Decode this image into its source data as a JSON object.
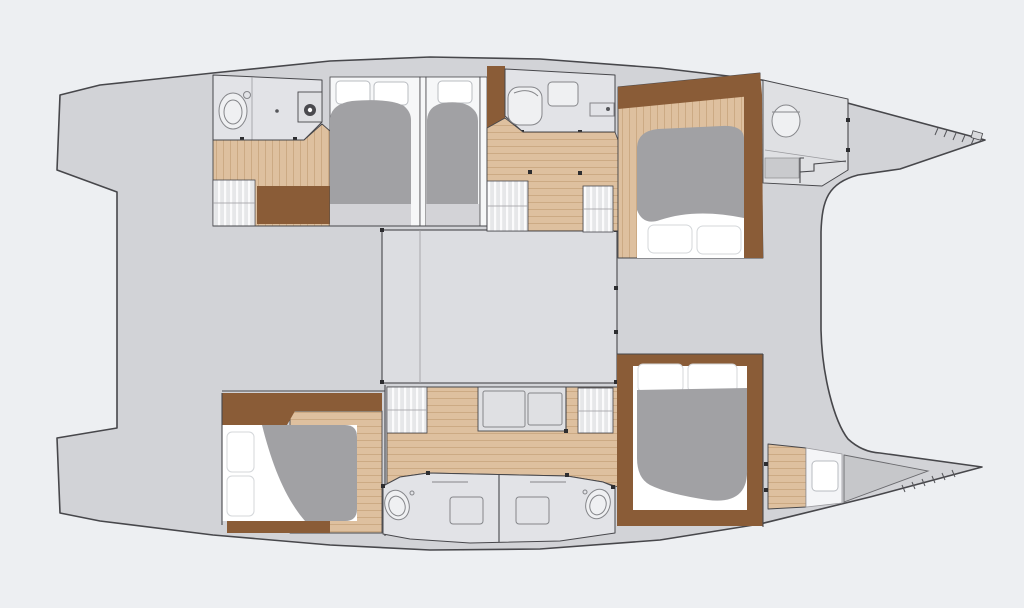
{
  "diagram": {
    "kind": "floor-plan",
    "subject": "catamaran-yacht-deck-layout",
    "orientation": "bow-right",
    "aria_label": "Catamaran yacht floor plan with bow facing right",
    "visible_text_items": []
  },
  "palette": {
    "bg": "#edeff2",
    "deck": "#d2d3d7",
    "saloon": "#dcdde1",
    "cabinWhite": "#f6f7f8",
    "mattress": "#ffffff",
    "wood": "#dec09f",
    "woodLine": "#c8a47d",
    "woodDark": "#8a5c37",
    "bedGray": "#a1a1a4",
    "benchGray": "#d3d3d7",
    "bath": "#e2e3e7",
    "steps": "#e6e7e9",
    "stepsBar": "#fbfbfc",
    "forepeak": "#c6c7ca",
    "bowRoom": "#dfe0e3",
    "outline": "#47474b",
    "fixture": "#85868a",
    "fixtureFill": "#eff0f2",
    "windowStroke": "#b9bcc1",
    "counter": "#dfe0e3"
  },
  "features": {
    "legend": [
      "hull-silhouette",
      "aft-cockpit-deck",
      "saloon-footprint",
      "double-berth",
      "duvet",
      "pillow",
      "hull-window",
      "bathroom",
      "toilet",
      "shower",
      "sink",
      "companionway-steps",
      "wood-floor",
      "cabinet",
      "galley-unit",
      "forepeak-locker",
      "bow-tip-fitting",
      "lashing-ticks"
    ]
  }
}
